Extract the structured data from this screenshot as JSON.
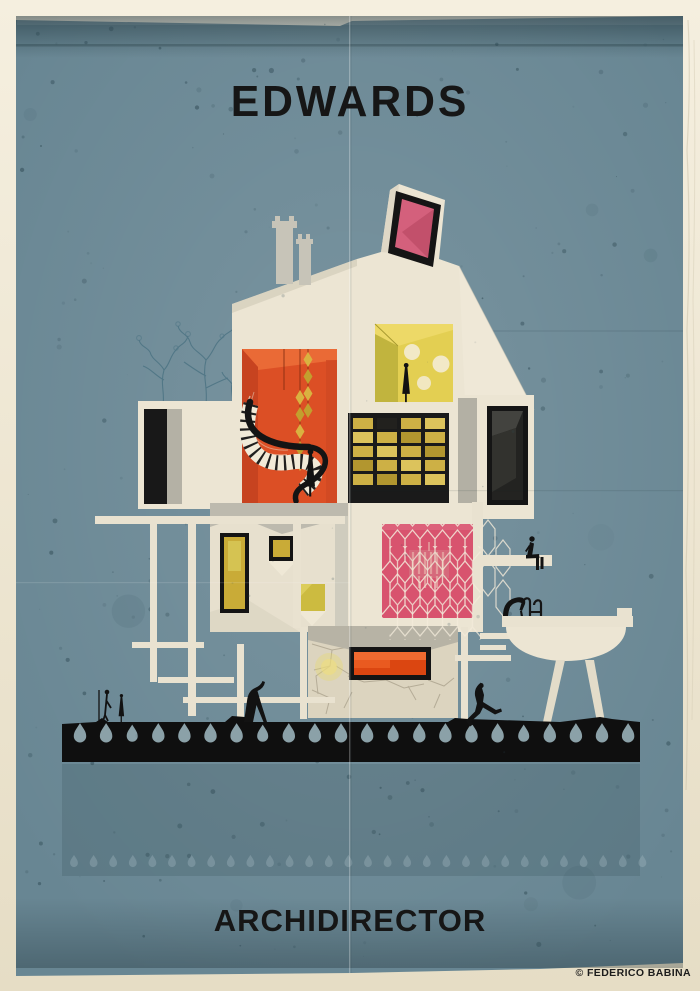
{
  "poster": {
    "title": "EDWARDS",
    "series": "ARCHIDIRECTOR",
    "credit": "© FEDERICO BABINA"
  },
  "art": {
    "colors": {
      "paper": "#eee6d4",
      "paper_edge": "#d9d0b8",
      "poster_blue": "#688693",
      "poster_blue_deep": "#4f666e",
      "ink": "#161616",
      "house_cream": "#ece5d3",
      "house_gray": "#b5b2a6",
      "room_orange": "#dc4f25",
      "room_orange_dark": "#c74320",
      "room_yellow": "#e3cf52",
      "room_pink": "#d8536e",
      "skylight_pink": "#d4607c",
      "window_gold": "#c9ab37",
      "fireplace_orange": "#e95a20",
      "stone": "#dcd4bf",
      "drop": "#92aab1",
      "speckle": "#2f4a54",
      "tree": "#4a7282"
    }
  }
}
